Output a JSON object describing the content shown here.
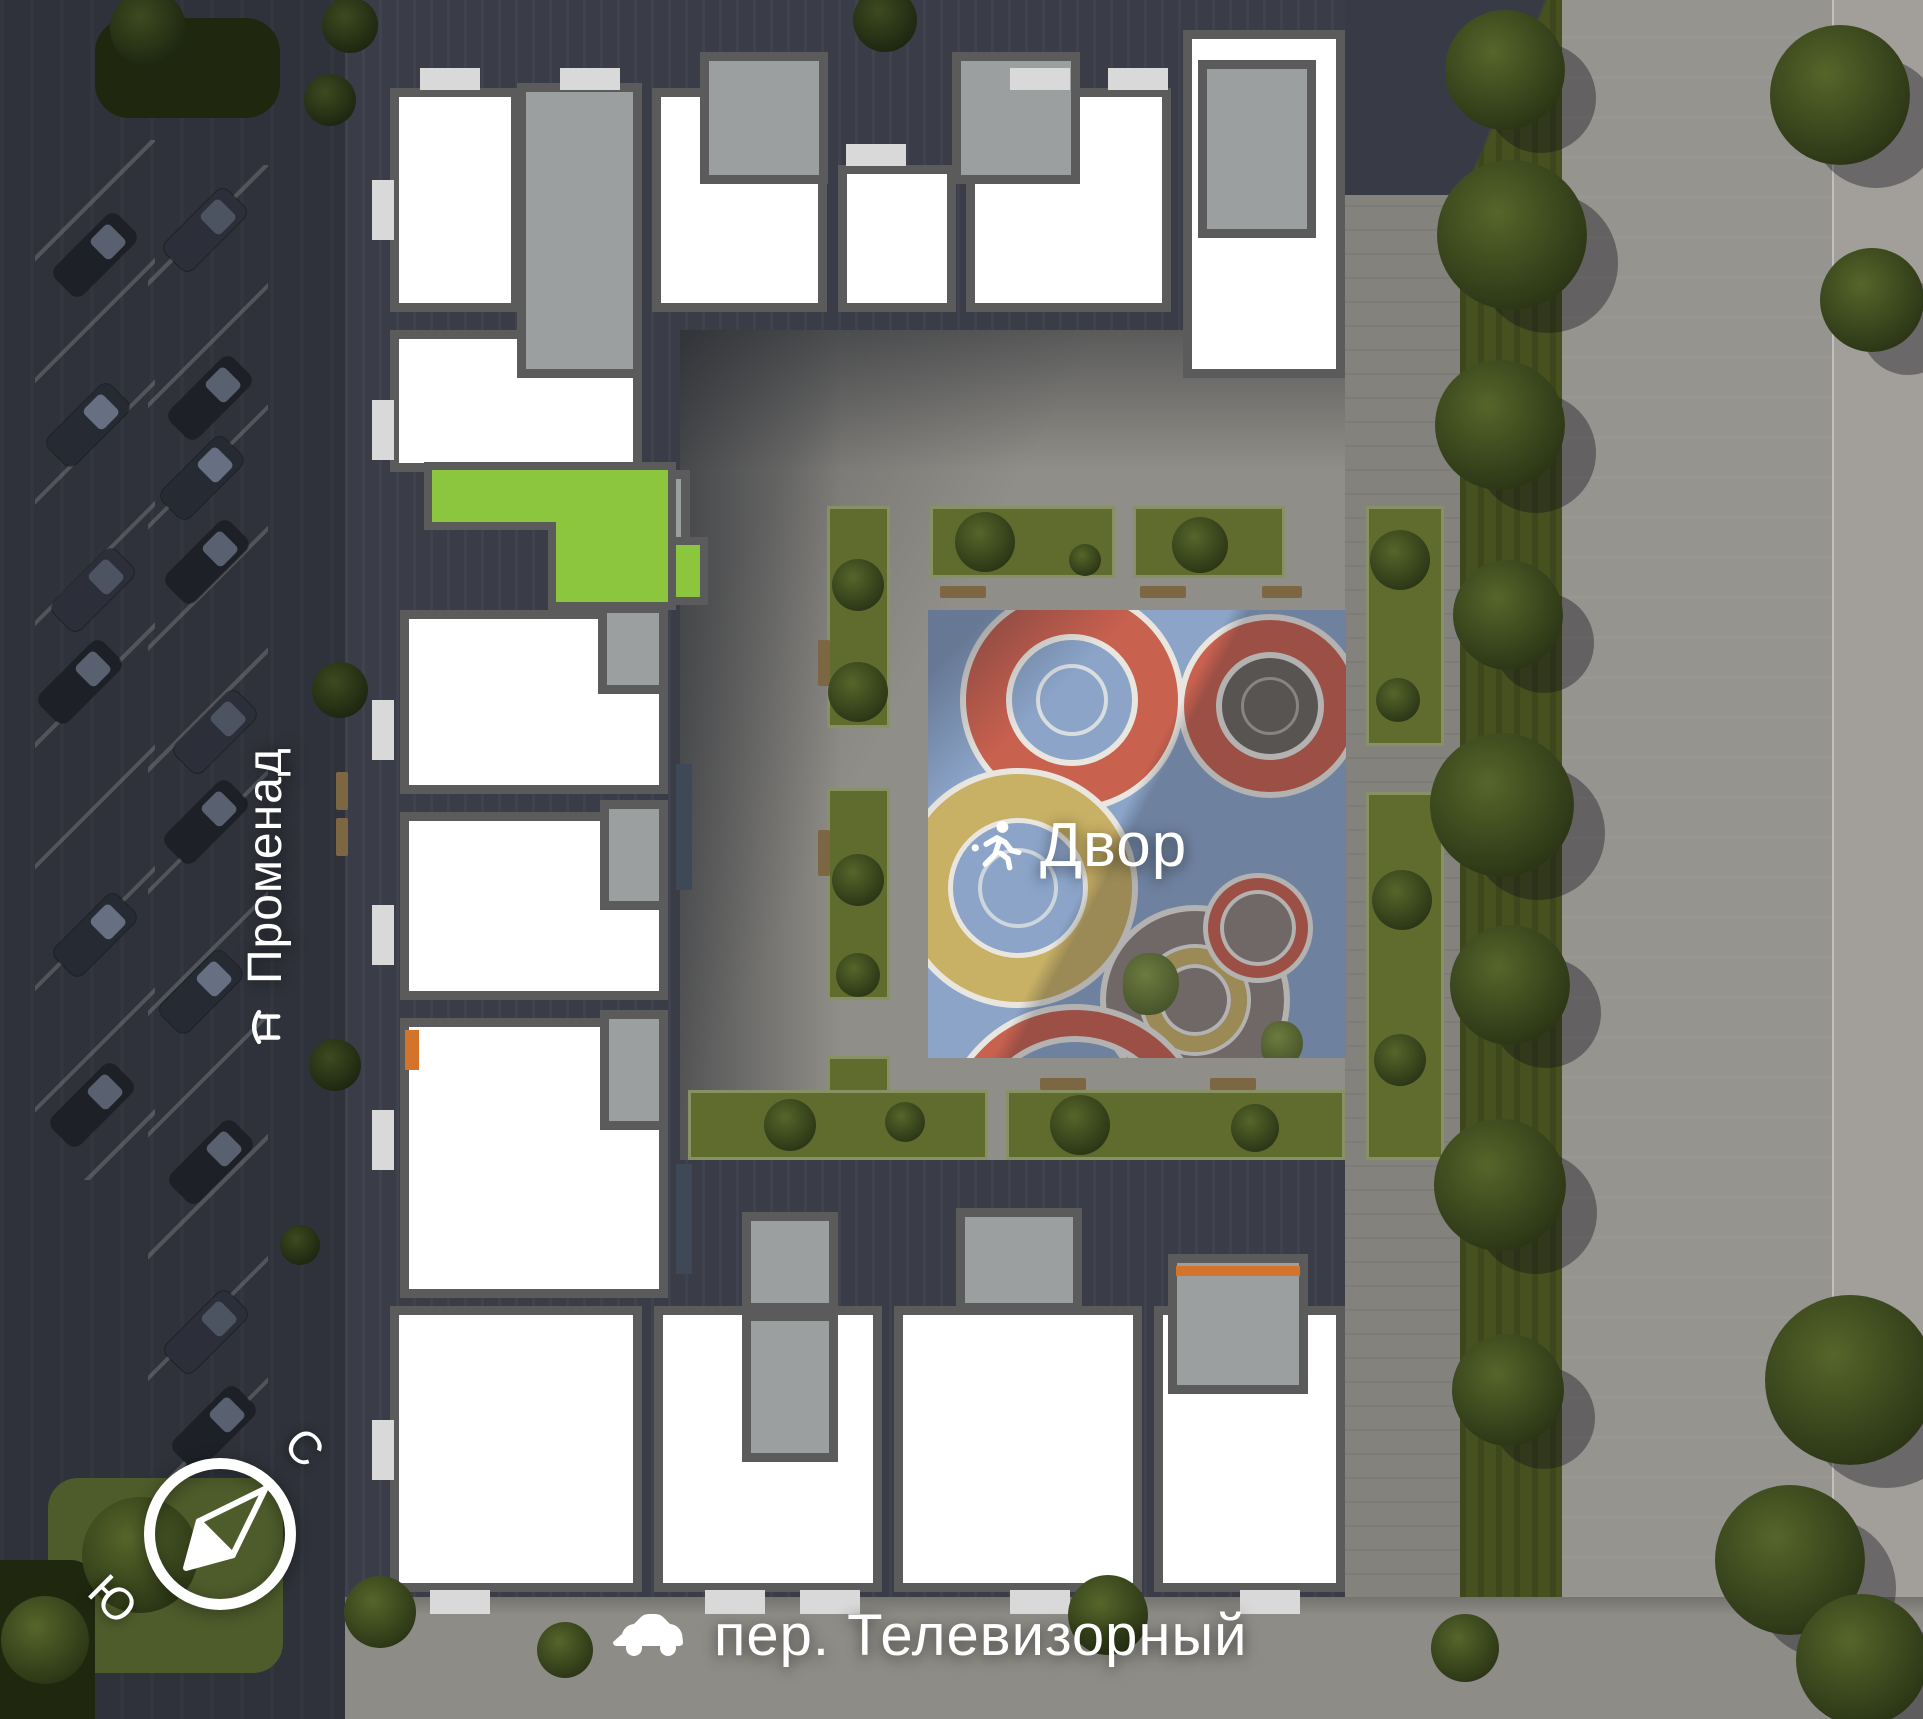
{
  "labels": {
    "courtyard": "Двор",
    "street_left": "Променад",
    "street_bottom": "пер. Телевизорный",
    "compass": {
      "north": "С",
      "south": "Ю"
    }
  },
  "icons": {
    "courtyard": "runner-icon",
    "street_left": "bench-icon",
    "street_bottom": "car-icon",
    "compass": "compass-needle-icon"
  },
  "selection": {
    "highlighted_unit": "selected-apartment",
    "highlight_color": "#8CC63E"
  },
  "colors": {
    "highlight_green": "#8CC63E",
    "playground_blue": "#8BA4C8",
    "ring_red": "#C9614F",
    "disc_yellow": "#C8B065",
    "disc_taupe": "#8D827C",
    "unit_white": "#FFFFFF",
    "wall_gray": "#5B5B5B",
    "core_gray": "#9C9FA0",
    "accent_orange": "#D4732A"
  }
}
